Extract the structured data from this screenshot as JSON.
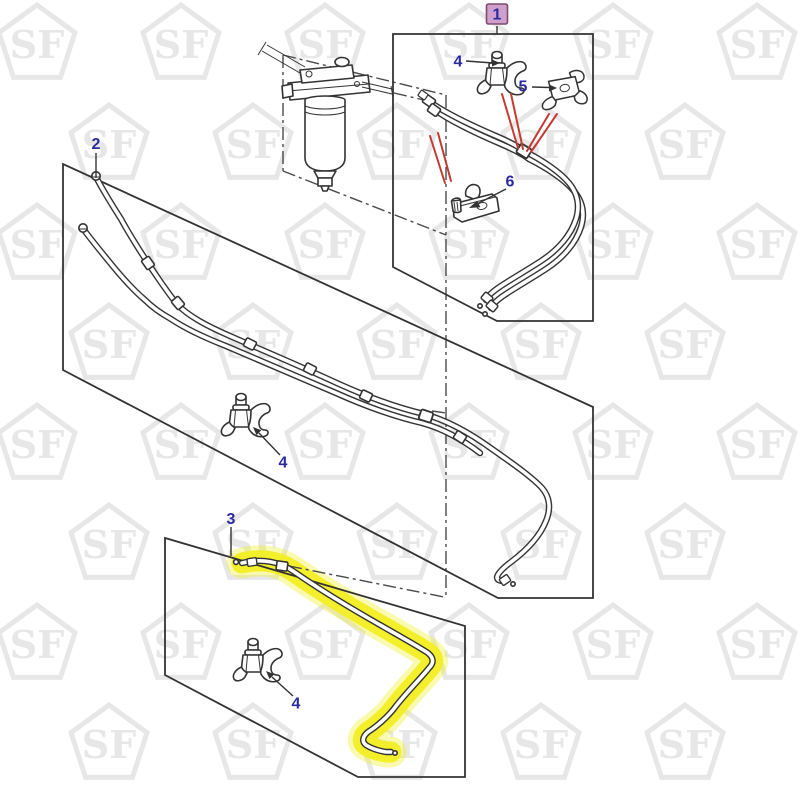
{
  "diagram": {
    "watermark": {
      "text": "SF",
      "y0": 45,
      "dy": 100,
      "dx": 144,
      "x0_even": 37,
      "x0_odd": 109,
      "rows": 8,
      "cols_even": 6,
      "cols_odd": 5
    },
    "colors": {
      "line": "#333333",
      "label_blue": "#2a2aa0",
      "leader_red": "#c23b33",
      "highlight_yellow": "#f2ee1e",
      "callout1_bg": "#d0a0cd",
      "callout1_border": "#7e4a6e",
      "watermark_gray": "#e7e7e7"
    },
    "callouts": {
      "c1": {
        "label": "1",
        "selected": true
      },
      "c2": {
        "label": "2"
      },
      "c3": {
        "label": "3"
      },
      "c4_box1": {
        "label": "4"
      },
      "c5": {
        "label": "5"
      },
      "c6": {
        "label": "6"
      },
      "c4_box2": {
        "label": "4"
      },
      "c4_box3": {
        "label": "4"
      }
    }
  }
}
